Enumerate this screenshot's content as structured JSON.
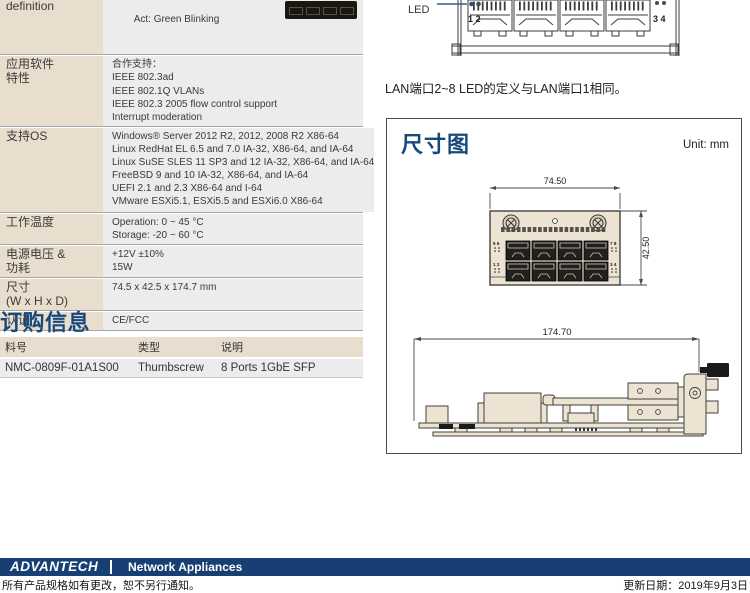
{
  "colors": {
    "accent_navy": "#174a7c",
    "table_label_beige": "#e9decd",
    "table_value_gray": "#ececec",
    "footer_bar_navy": "#173f73",
    "led_leader_blue": "#2e5d96"
  },
  "spec_table": {
    "rows": [
      {
        "label": "definition",
        "value": "Act: Green Blinking"
      },
      {
        "label": "应用软件\n特性",
        "value": "合作支持：\nIEEE 802.3ad\nIEEE 802.1Q VLANs\nIEEE 802.3 2005 flow control support\nInterrupt moderation"
      },
      {
        "label": "支持OS",
        "value": "Windows® Server 2012 R2, 2012, 2008 R2 X86-64\nLinux RedHat EL 6.5 and 7.0 IA-32, X86-64, and IA-64\nLinux SuSE SLES 11 SP3 and 12 IA-32, X86-64, and IA-64\nFreeBSD 9 and 10 IA-32, X86-64, and IA-64\nUEFI 2.1 and 2.3 X86-64 and I-64\nVMware ESXi5.1, ESXi5.5 and ESXi6.0 X86-64"
      },
      {
        "label": "工作温度",
        "value": "Operation: 0 ~ 45 °C\nStorage: -20 ~ 60 °C"
      },
      {
        "label": "电源电压 &\n功耗",
        "value": "+12V ±10%\n15W"
      },
      {
        "label": "尺寸\n(W x H x D)",
        "value": "74.5 x 42.5 x 174.7 mm"
      },
      {
        "label": "认证",
        "value": "CE/FCC"
      }
    ]
  },
  "led_figure": {
    "led_label": "LED",
    "left_port_numbers": "1 2",
    "right_port_numbers": "3 4",
    "caption": "LAN端口2~8 LED的定义与LAN端口1相同。"
  },
  "ordering": {
    "heading": "订购信息",
    "headers": [
      "料号",
      "类型",
      "说明"
    ],
    "rows": [
      [
        "NMC-0809F-01A1S00",
        "Thumbscrew",
        "8 Ports 1GbE SFP"
      ]
    ]
  },
  "dimension_figure": {
    "heading": "尺寸图",
    "unit_label": "Unit: mm",
    "front_width_mm": "74.50",
    "front_height_mm": "42.50",
    "side_depth_mm": "174.70",
    "front_port_labels": {
      "top_left": "5 6",
      "top_right": "7 8",
      "bottom_left": "1 2",
      "bottom_right": "3 4"
    }
  },
  "footer": {
    "brand": "ADVANTECH",
    "series_title": "Network Appliances",
    "note": "所有产品规格如有更改，恕不另行通知。",
    "updated": "更新日期：2019年9月3日"
  }
}
